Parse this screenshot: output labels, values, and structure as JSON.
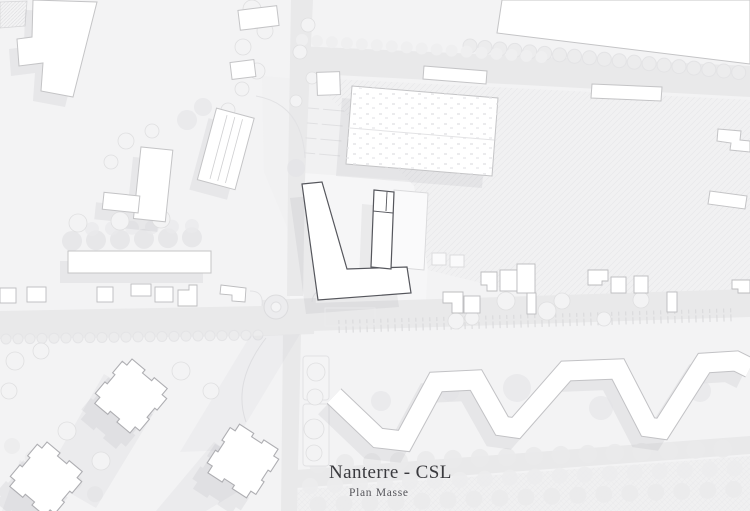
{
  "title": {
    "main": "Nanterre - CSL",
    "subtitle": "Plan Masse"
  },
  "colors": {
    "background": "#f3f3f4",
    "road": "#e9e9ea",
    "building_fill": "#ffffff",
    "building_outline": "#c4c4c6",
    "project_outline": "#55565c",
    "shadow": "#8d8d96",
    "vegetation_outline": "#dfdfe0",
    "text_primary": "#3a3a3e",
    "text_secondary": "#55555a"
  }
}
